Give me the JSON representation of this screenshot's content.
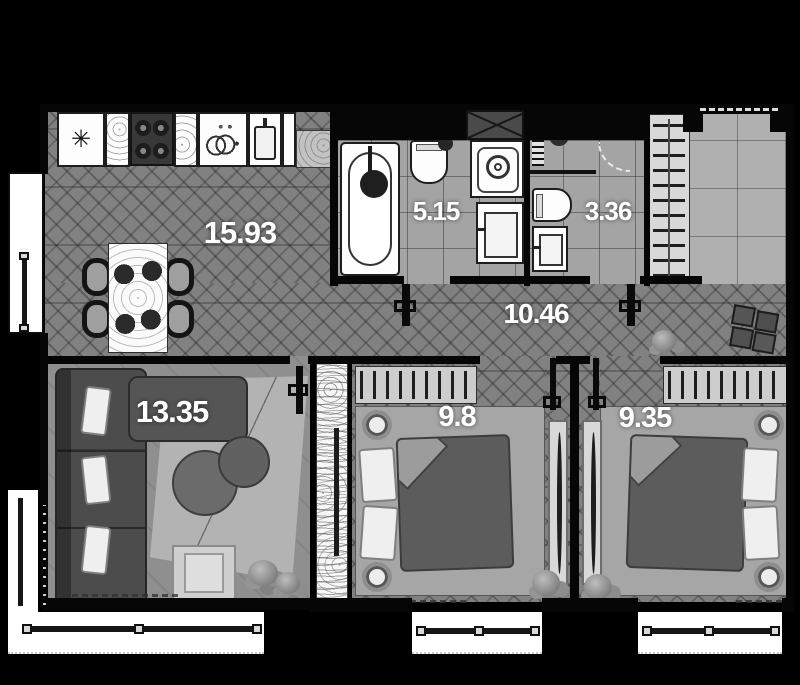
{
  "plan_type": "apartment-floor-plan",
  "rooms": {
    "kitchen_living": {
      "area": "15.93"
    },
    "bathroom": {
      "area": "5.15"
    },
    "wc": {
      "area": "3.36"
    },
    "hallway": {
      "area": "10.46"
    },
    "living_room": {
      "area": "13.35"
    },
    "bedroom_1": {
      "area": "9.8"
    },
    "bedroom_2": {
      "area": "9.35"
    }
  },
  "fixtures": {
    "freezer_icon": "✳"
  },
  "colors": {
    "background": "#000000",
    "walls": "#060606",
    "wood_floor": "#7a7a7a",
    "tile_floor": "#a4a4a4",
    "label_text": "#ffffff",
    "furniture_dark": "#4c4c4c",
    "fixture_white": "#fdfdfd"
  }
}
